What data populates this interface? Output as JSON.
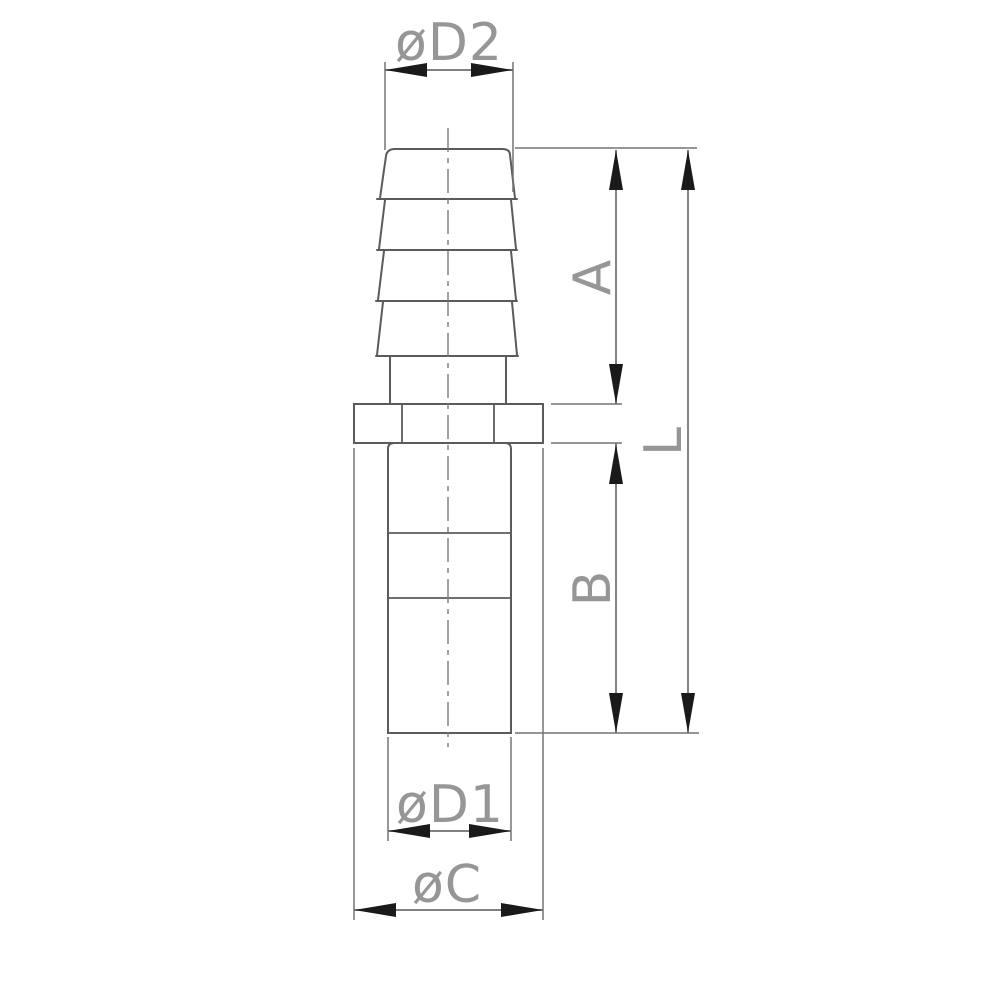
{
  "drawing": {
    "kind": "technical dimension drawing",
    "view": "hose barb adapter fitting, front elevation with dimension callouts",
    "part": {
      "sections": [
        {
          "name": "hose-barb-stem",
          "barb_count": 4
        },
        {
          "name": "hex-collar"
        },
        {
          "name": "cylindrical-body"
        }
      ]
    },
    "dimension_labels": {
      "d2": "øD2",
      "a": "A",
      "l": "L",
      "b": "B",
      "d1": "øD1",
      "c": "øC"
    },
    "dimensions": [
      {
        "id": "d2",
        "label": "øD2",
        "orientation": "horizontal",
        "location": "top, barb outer width"
      },
      {
        "id": "a",
        "label": "A",
        "orientation": "vertical",
        "location": "right inner, top of barb to collar top"
      },
      {
        "id": "l",
        "label": "L",
        "orientation": "vertical",
        "location": "right outer, top of barb to body bottom"
      },
      {
        "id": "b",
        "label": "B",
        "orientation": "vertical",
        "location": "right inner, collar bottom to body bottom"
      },
      {
        "id": "d1",
        "label": "øD1",
        "orientation": "horizontal",
        "location": "bottom, body width"
      },
      {
        "id": "c",
        "label": "øC",
        "orientation": "horizontal",
        "location": "bottom, collar width"
      }
    ],
    "colors": {
      "background": "#ffffff",
      "part_line": "#5b5b5b",
      "dimension_line": "#6e6e6e",
      "arrow": "#1a1a1a",
      "label_text": "#969696"
    }
  }
}
